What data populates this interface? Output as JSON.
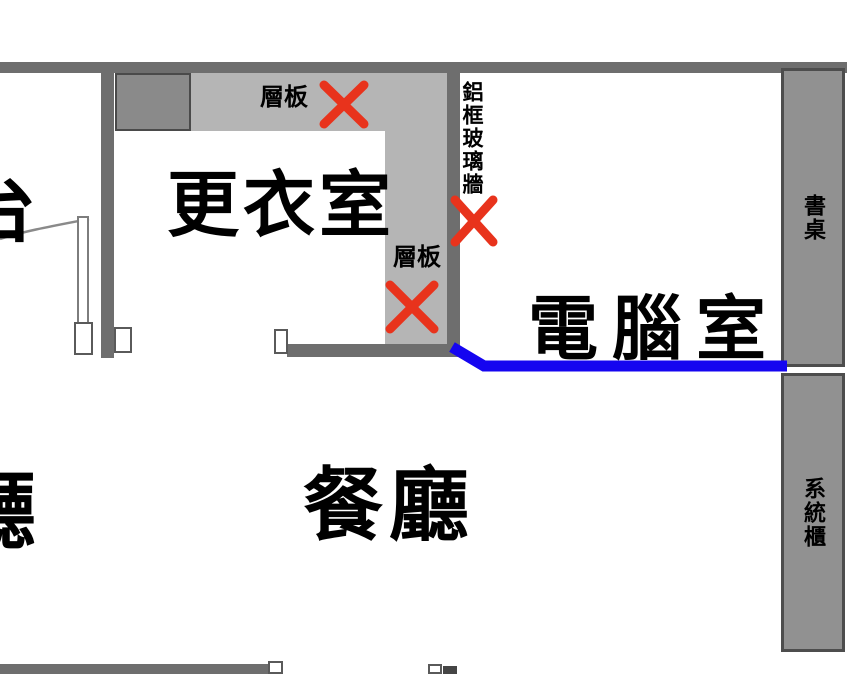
{
  "rooms": {
    "dressing_room": "更衣室",
    "dining_room": "餐廳",
    "computer_room": "電腦室",
    "living_room_partial": "廳",
    "balcony_partial": "台"
  },
  "labels": {
    "shelf_top": "層板",
    "shelf_side": "層板",
    "glass_wall": "鋁框玻璃牆",
    "desk": "書桌",
    "system_cabinet": "系統櫃"
  },
  "colors": {
    "wall": "#6e6e6e",
    "shelf_fill": "#b5b5b5",
    "dark_box_fill": "#8a8a8a",
    "column_fill": "#919191",
    "column_border": "#4d4d4d",
    "removal_x": "#e8331c",
    "blue_marker": "#1505f0",
    "text": "#000000",
    "background": "#ffffff"
  }
}
